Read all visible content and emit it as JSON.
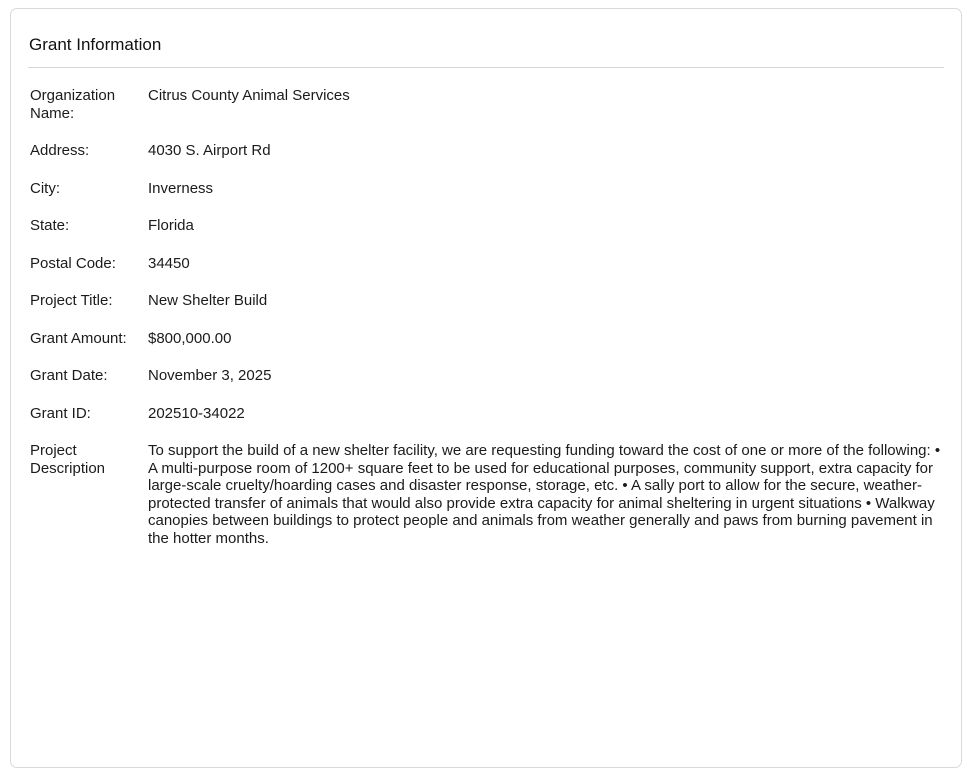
{
  "card": {
    "title": "Grant Information",
    "fields": [
      {
        "label": "Organization Name:",
        "value": "Citrus County Animal Services"
      },
      {
        "label": "Address:",
        "value": "4030 S. Airport Rd"
      },
      {
        "label": "City:",
        "value": "Inverness"
      },
      {
        "label": "State:",
        "value": "Florida"
      },
      {
        "label": "Postal Code:",
        "value": "34450"
      },
      {
        "label": "Project Title:",
        "value": "New Shelter Build"
      },
      {
        "label": "Grant Amount:",
        "value": "$800,000.00"
      },
      {
        "label": "Grant Date:",
        "value": "November 3, 2025"
      },
      {
        "label": "Grant ID:",
        "value": "202510-34022"
      },
      {
        "label": "Project Description",
        "value": "To support the build of a new shelter facility, we are requesting funding toward the cost of one or more of the following: • A multi-purpose room of 1200+ square feet to be used for educational purposes, community support, extra capacity for large-scale cruelty/hoarding cases and disaster response, storage, etc. • A sally port to allow for the secure, weather-protected transfer of animals that would also provide extra capacity for animal sheltering in urgent situations • Walkway canopies between buildings to protect people and animals from weather generally and paws from burning pavement in the hotter months."
      }
    ]
  },
  "colors": {
    "background": "#ffffff",
    "card_border": "#d9d9d9",
    "divider": "#d7d7d7",
    "text": "#1b1b1b"
  }
}
